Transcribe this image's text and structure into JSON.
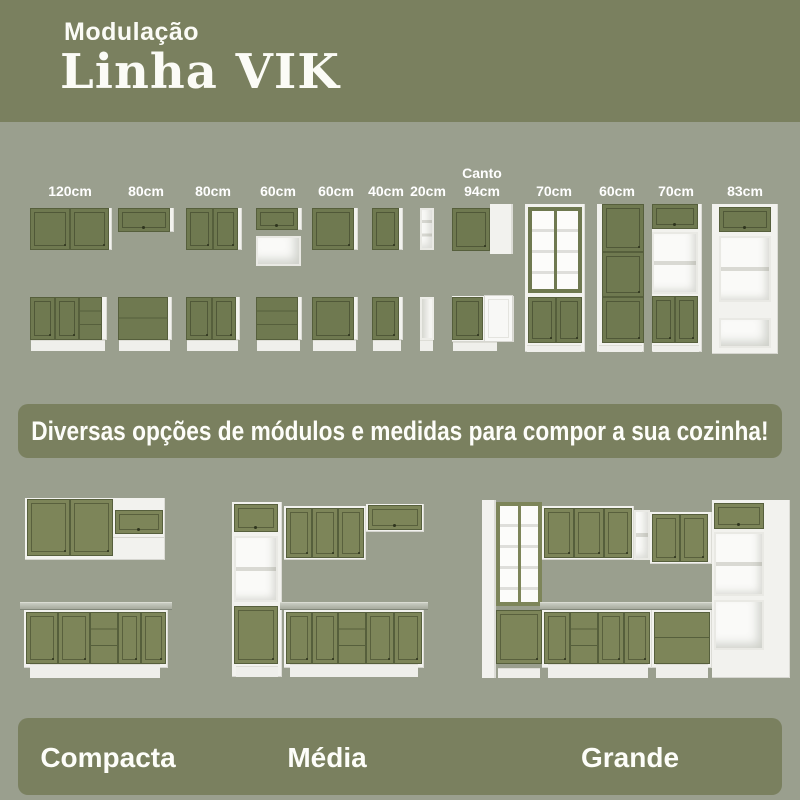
{
  "header": {
    "kicker": "Modulação",
    "title": "Linha VIK"
  },
  "modules": {
    "items": [
      {
        "label": "120cm"
      },
      {
        "label": "80cm"
      },
      {
        "label": "80cm"
      },
      {
        "label": "60cm"
      },
      {
        "label": "60cm"
      },
      {
        "label": "40cm"
      },
      {
        "label": "20cm"
      },
      {
        "label": "Canto 94cm"
      },
      {
        "label": "70cm"
      },
      {
        "label": "60cm"
      },
      {
        "label": "70cm"
      },
      {
        "label": "83cm"
      }
    ]
  },
  "banner": {
    "text": "Diversas opções de módulos e medidas para compor a sua cozinha!"
  },
  "kitchens": {
    "items": [
      {
        "label": "Compacta"
      },
      {
        "label": "Média"
      },
      {
        "label": "Grande"
      }
    ]
  },
  "colors": {
    "olive_band": "#7a805f",
    "page_background": "#9a9f8e",
    "cabinet_green": "#6f7950",
    "kitchen_green": "#7d8559",
    "carcass_white": "#f2f2ee",
    "countertop_gray": "#aeb2a4",
    "text_white": "#ffffff"
  }
}
